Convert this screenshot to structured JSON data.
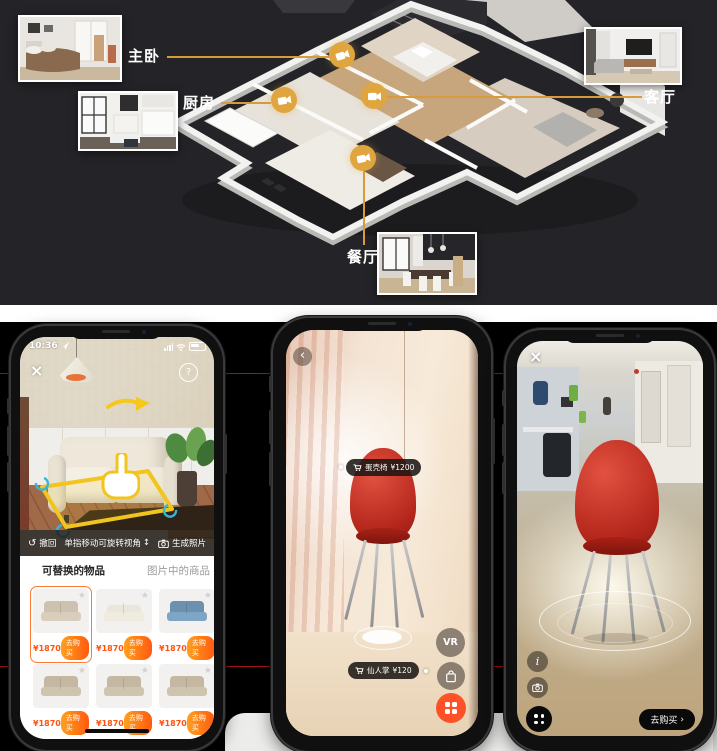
{
  "top": {
    "rooms": [
      {
        "id": "master-bedroom",
        "label": "主卧"
      },
      {
        "id": "kitchen",
        "label": "厨房"
      },
      {
        "id": "living-room",
        "label": "客厅"
      },
      {
        "id": "dining-room",
        "label": "餐厅"
      }
    ]
  },
  "phone1": {
    "time": "10:36",
    "close_glyph": "×",
    "help_glyph": "?",
    "toolbar": {
      "undo_icon": "↺",
      "undo_label": "撤回",
      "hint_label": "单指移动可旋转视角",
      "hint_icon": "↕",
      "generate_label": "生成照片"
    },
    "tabs": [
      {
        "label": "可替换的物品"
      },
      {
        "label": "图片中的商品"
      }
    ],
    "star_glyph": "★",
    "products": [
      {
        "price": "¥1870",
        "buy_label": "去购买"
      },
      {
        "price": "¥1870",
        "buy_label": "去购买"
      },
      {
        "price": "¥1870",
        "buy_label": "去购买"
      },
      {
        "price": "¥1870",
        "buy_label": "去购买"
      },
      {
        "price": "¥1870",
        "buy_label": "去购买"
      },
      {
        "price": "¥1870",
        "buy_label": "去购买"
      }
    ]
  },
  "phone2": {
    "back_glyph": "‹",
    "item_tag": {
      "name": "蛋壳椅",
      "price": "¥1200"
    },
    "floor_tag": {
      "name": "仙人掌",
      "price": "¥120"
    },
    "vr_label": "VR"
  },
  "phone3": {
    "close_glyph": "×",
    "info_glyph": "i",
    "buy_label": "去购买",
    "chevron": "›"
  },
  "colors": {
    "accent_gold": "#E0A53E",
    "divider_red": "#A9151B",
    "price_orange": "#FF5310",
    "buy_gradient_start": "#FFA01E",
    "buy_gradient_end": "#FF5A10",
    "selection_yellow": "#F2C41E",
    "cta_orange": "#FF5126",
    "top_background": "#242428",
    "bottom_background": "#000000"
  }
}
